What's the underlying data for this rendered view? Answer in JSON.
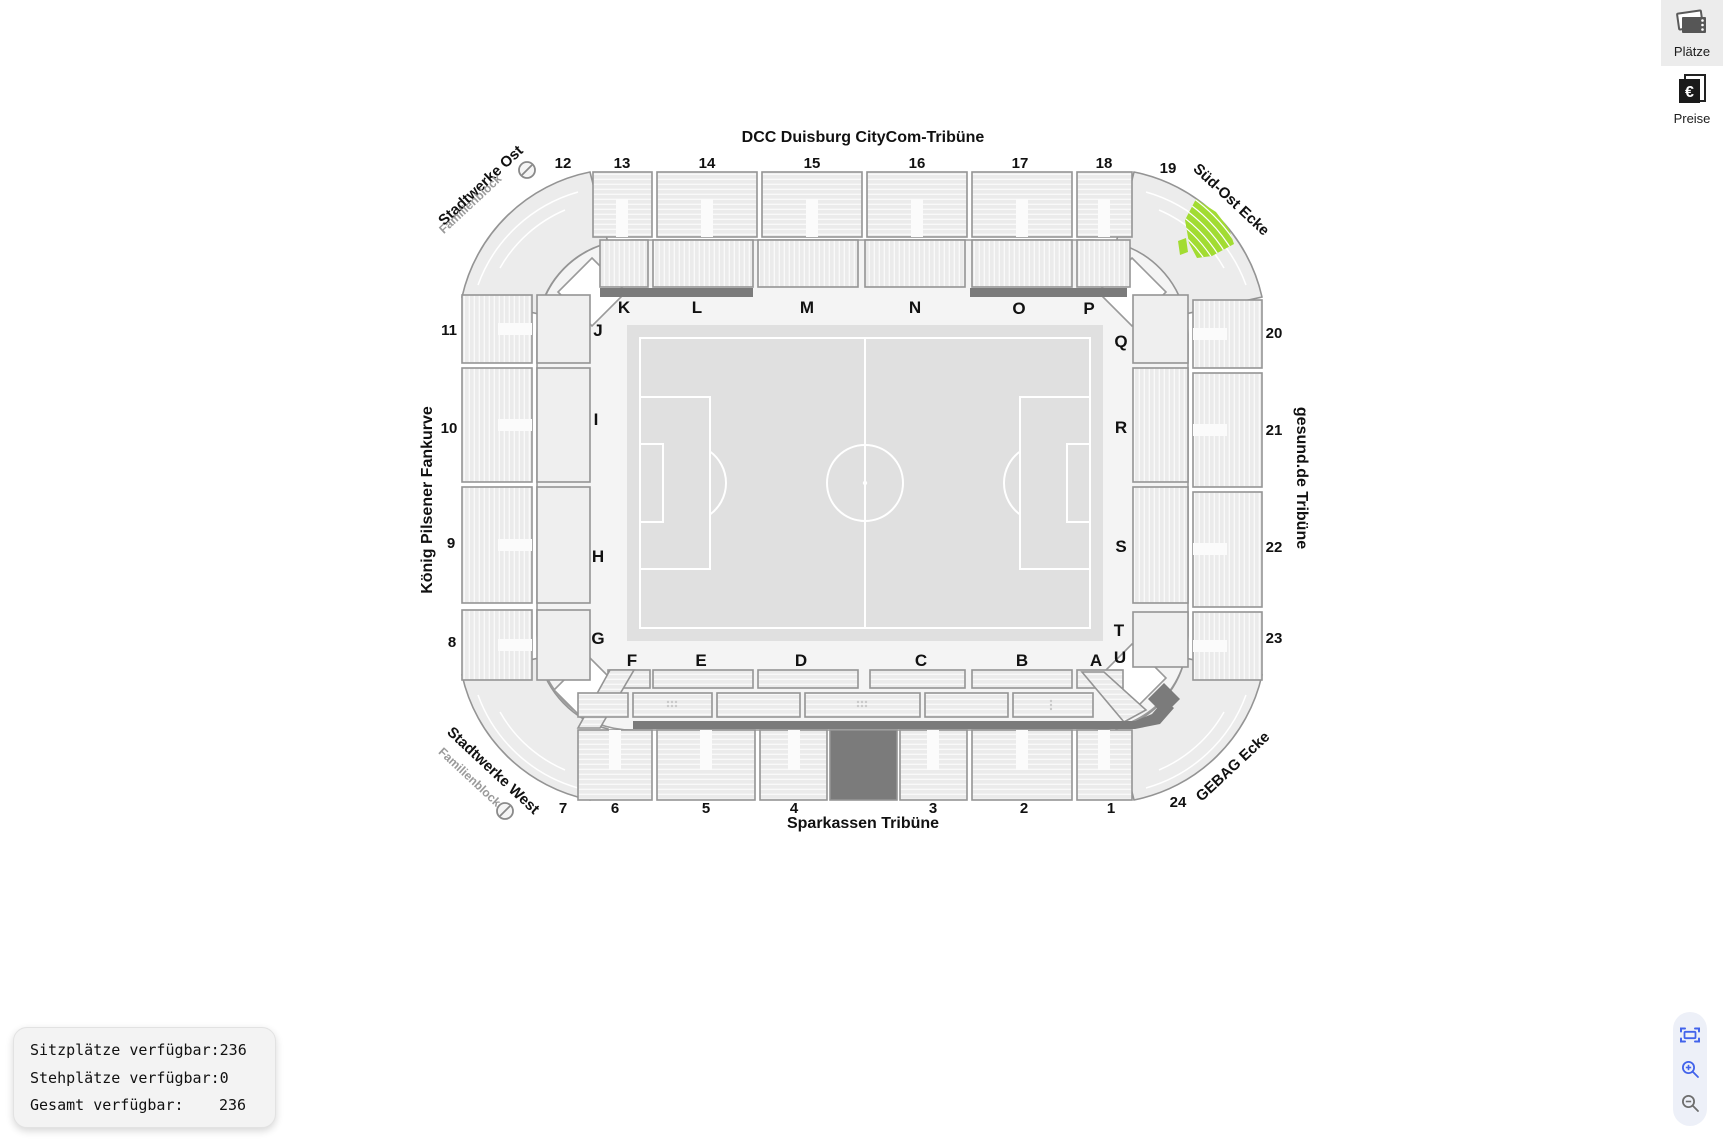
{
  "toolbar": {
    "places_label": "Plätze",
    "prices_label": "Preise"
  },
  "availability": {
    "rows": [
      {
        "label": "Sitzplätze verfügbar:",
        "value": "236"
      },
      {
        "label": "Stehplätze verfügbar:",
        "value": "0"
      },
      {
        "label": "Gesamt verfügbar:",
        "value": "236"
      }
    ]
  },
  "stadium": {
    "stand_names": {
      "north": "DCC Duisburg CityCom-Tribüne",
      "south": "Sparkassen Tribüne",
      "west": "König Pilsener Fankurve",
      "east": "gesund.de Tribüne"
    },
    "corner_names": {
      "northwest": "Stadtwerke Ost",
      "northwest_sub": "Familienblock",
      "northeast": "Süd-Ost Ecke",
      "southwest": "Stadtwerke West",
      "southwest_sub": "Familienblock",
      "southeast": "GEBAG Ecke"
    },
    "top_numbers": [
      "12",
      "13",
      "14",
      "15",
      "16",
      "17",
      "18",
      "19"
    ],
    "left_numbers": [
      "11",
      "10",
      "9",
      "8"
    ],
    "right_numbers": [
      "20",
      "21",
      "22",
      "23"
    ],
    "bottom_numbers": [
      "7",
      "6",
      "5",
      "4",
      "3",
      "2",
      "1",
      "24"
    ],
    "inner_letters_top": [
      "K",
      "L",
      "M",
      "N",
      "O",
      "P"
    ],
    "inner_letters_left": [
      "J",
      "I",
      "H",
      "G"
    ],
    "inner_letters_right": [
      "Q",
      "R",
      "S",
      "T",
      "U"
    ],
    "inner_letters_bottom": [
      "F",
      "E",
      "D",
      "C",
      "B",
      "A"
    ],
    "colors": {
      "available_block": "#a2dc32",
      "closed_dark": "#7b7b7b",
      "block_fill": "#ececec",
      "pitch": "#e0e0e0"
    }
  }
}
